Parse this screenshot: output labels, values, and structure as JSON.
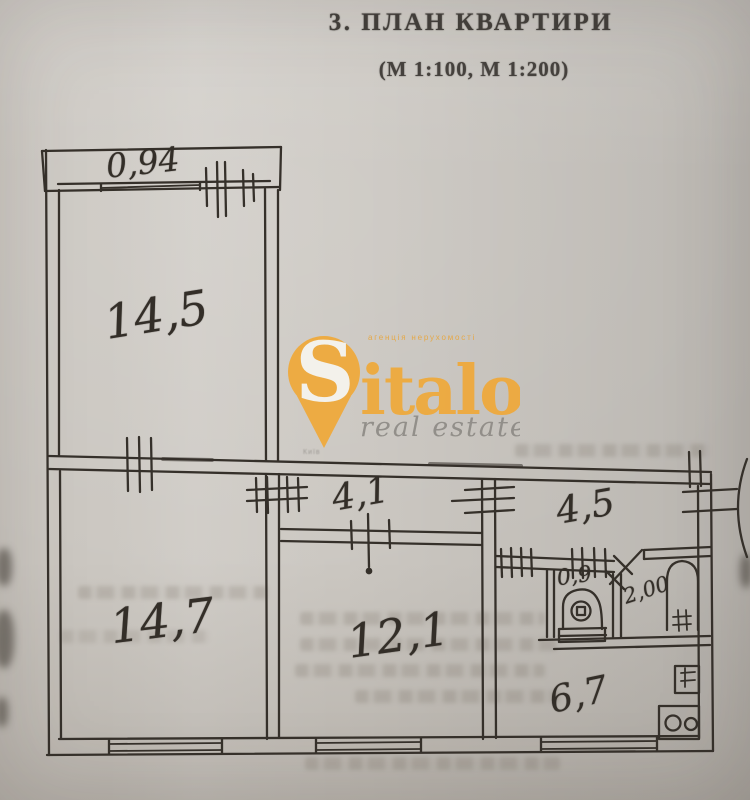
{
  "document": {
    "title": "3. ПЛАН КВАРТИРИ",
    "scale_note": "(М 1:100, М 1:200)"
  },
  "room_labels": {
    "balcony": "0,94",
    "room_top": "14,5",
    "corridor": "4,1",
    "hallway": "4,5",
    "room_bottom_left": "14,7",
    "room_bottom_mid": "12,1",
    "wc": "0,9",
    "bathroom": "2,00",
    "kitchen": "6,7"
  },
  "watermark": {
    "agency_line": "агенція нерухомості",
    "brand_initial": "S",
    "brand_rest": "italo",
    "tagline": "real estate",
    "city_mark": "Київ",
    "brand_color": "#efa93a",
    "tagline_color": "#8e8b86"
  },
  "ink_color": "#35302a",
  "paper_color": "#cbc7c1"
}
